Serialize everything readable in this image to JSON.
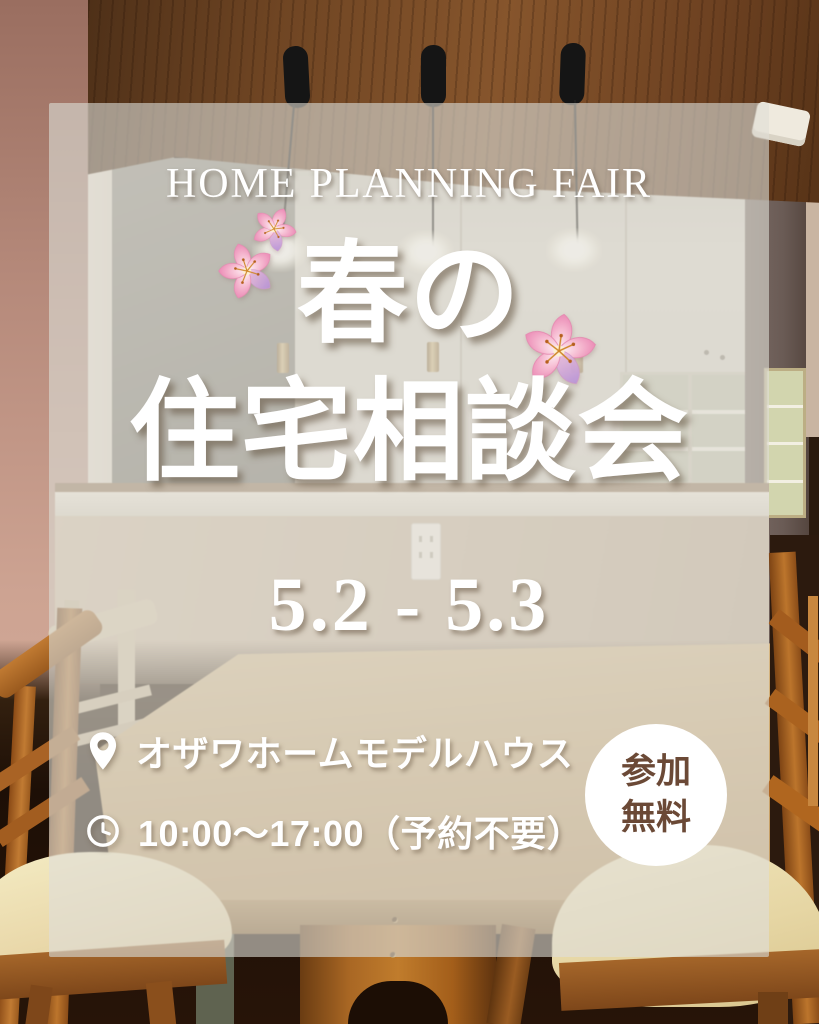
{
  "poster": {
    "tagline": "HOME PLANNING FAIR",
    "title": {
      "line1": "春の",
      "line2": "住宅相談会"
    },
    "dates": "5.2 - 5.3",
    "info": [
      {
        "icon": "map-pin-icon",
        "text": "オザワホームモデルハウス"
      },
      {
        "icon": "clock-icon",
        "text": "10:00〜17:00（予約不要）"
      }
    ],
    "badge": {
      "line1": "参加",
      "line2": "無料"
    },
    "colors": {
      "text": "#ffffff",
      "badge_background": "#ffffff",
      "badge_text": "#6b4936",
      "overlay": "rgba(225,221,212,0.60)",
      "blossom_pink": "#f2a9c8"
    },
    "decorations": [
      "cherry-blossom-icon",
      "cherry-blossom-icon",
      "cherry-blossom-icon"
    ]
  }
}
